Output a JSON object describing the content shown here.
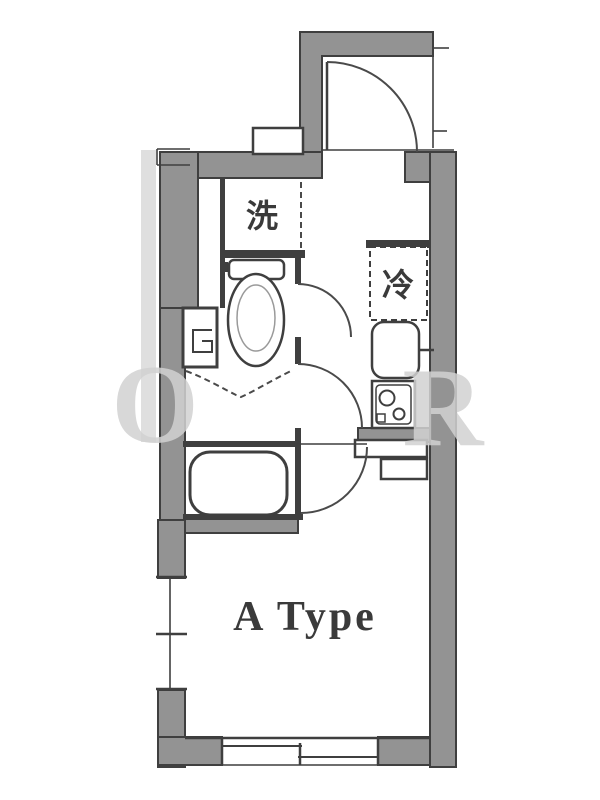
{
  "floorplan": {
    "room_label": "A Type",
    "washer_label": "洗",
    "fridge_label": "冷",
    "watermark": {
      "left_letter": "O",
      "right_letter": "R"
    },
    "colors": {
      "wall_fill": "#939393",
      "wall_outline": "#3f3f3f",
      "fixture_line": "#3f3f3f",
      "background": "#ffffff",
      "watermark": "#d2d2d2"
    }
  }
}
